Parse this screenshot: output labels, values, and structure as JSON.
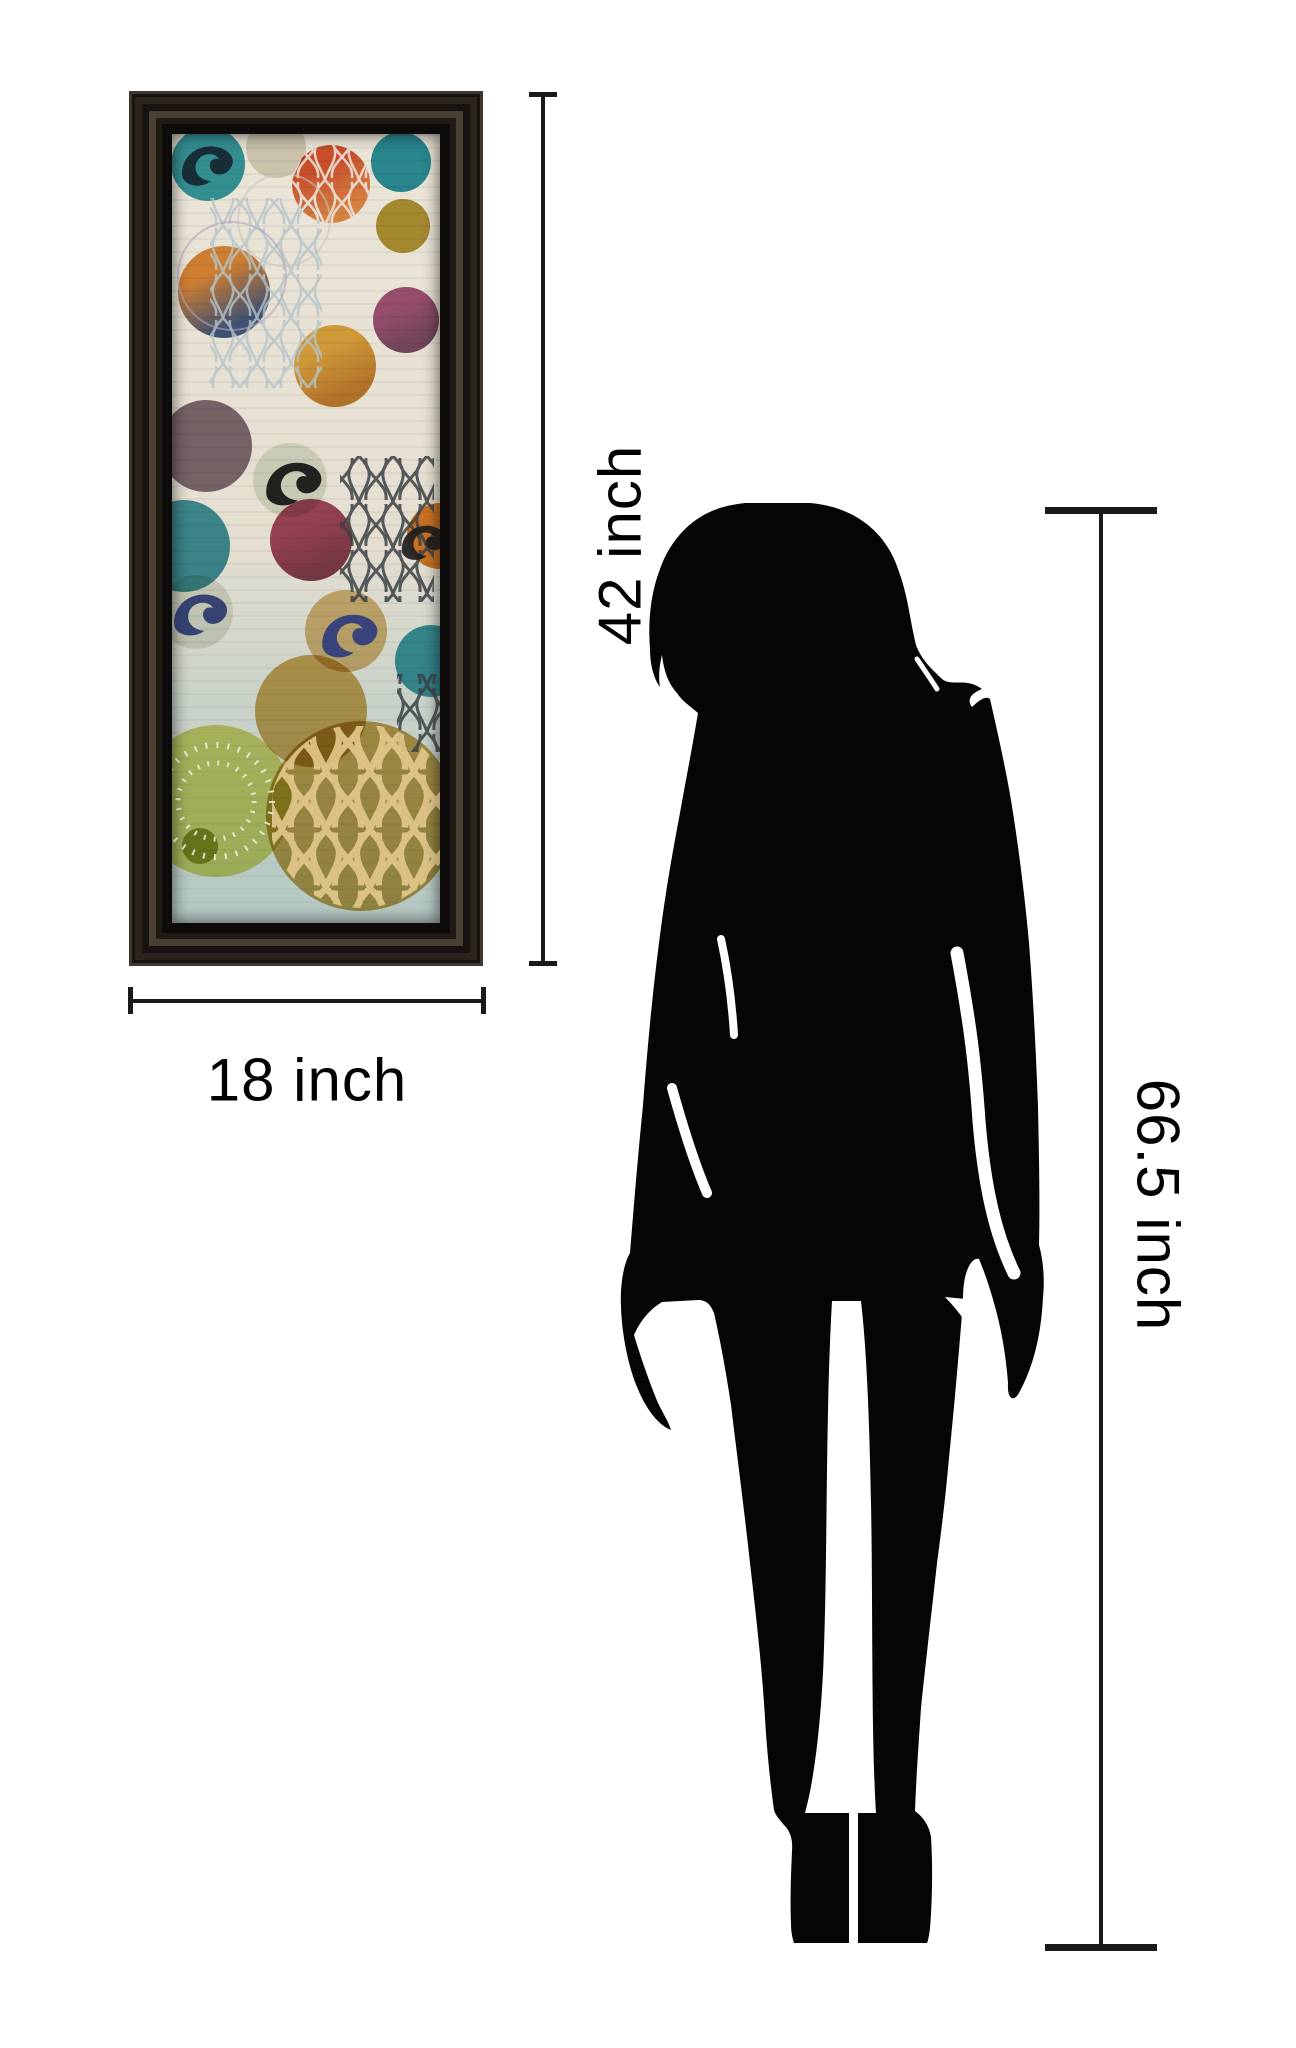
{
  "page": {
    "background": "#ffffff"
  },
  "labels": {
    "artwork_height": "42 inch",
    "artwork_width": "18 inch",
    "person_height": "66.5 inch"
  },
  "annotation_style": {
    "line_color": "#1a1a1a",
    "text_color": "#000000"
  },
  "figure": {
    "type": "standing-woman-silhouette",
    "color": "#000000"
  },
  "artwork": {
    "description": "Abstract print: colorful painted circles with Moroccan trellis and damask motifs on cream ground, dark espresso frame",
    "frame_color": "#1c1712",
    "background": "#e7e2d4",
    "circles": [
      {
        "x": 36,
        "y": 30,
        "r": 37,
        "color": "#2d9aa8",
        "opacity": 0.95
      },
      {
        "x": 104,
        "y": 14,
        "r": 30,
        "color": "#d9d4c6",
        "opacity": 0.9
      },
      {
        "x": 159,
        "y": 50,
        "r": 39,
        "color": "#d84e28",
        "color2": "#e98a45",
        "opacity": 0.95
      },
      {
        "x": 229,
        "y": 28,
        "r": 30,
        "color": "#1f8fa2",
        "opacity": 0.95
      },
      {
        "x": 231,
        "y": 92,
        "r": 27,
        "color": "#ac8d22",
        "opacity": 0.9
      },
      {
        "x": 52,
        "y": 158,
        "r": 46,
        "color": "#e2872f",
        "color2": "#3b5283",
        "opacity": 0.95
      },
      {
        "x": 163,
        "y": 232,
        "r": 41,
        "color": "#e5a93a",
        "color2": "#c27a28",
        "opacity": 0.95
      },
      {
        "x": 234,
        "y": 186,
        "r": 33,
        "color": "#9c4474",
        "color2": "#6d3a59",
        "opacity": 0.9
      },
      {
        "x": 34,
        "y": 312,
        "r": 46,
        "color": "#6b5564",
        "opacity": 0.85
      },
      {
        "x": 118,
        "y": 346,
        "r": 37,
        "color": "#dde6da",
        "opacity": 0.95
      },
      {
        "x": 139,
        "y": 406,
        "r": 41,
        "color": "#a03a55",
        "color2": "#7c2f45",
        "opacity": 0.92
      },
      {
        "x": 12,
        "y": 412,
        "r": 46,
        "color": "#2e8b9b",
        "opacity": 0.9
      },
      {
        "x": 24,
        "y": 478,
        "r": 37,
        "color": "#dfe3da",
        "opacity": 0.9
      },
      {
        "x": 268,
        "y": 402,
        "r": 33,
        "color": "#df7a20",
        "opacity": 0.95
      },
      {
        "x": 174,
        "y": 497,
        "r": 41,
        "color": "#d8b878",
        "opacity": 0.95
      },
      {
        "x": 259,
        "y": 527,
        "r": 36,
        "color": "#2a93a5",
        "opacity": 0.9
      },
      {
        "x": 139,
        "y": 577,
        "r": 56,
        "color": "#c49b3f",
        "opacity": 0.85
      },
      {
        "x": 44,
        "y": 667,
        "r": 76,
        "color": "#ccd04e",
        "opacity": 0.8
      },
      {
        "x": 28,
        "y": 712,
        "r": 18,
        "color": "#99a23a",
        "opacity": 0.9
      },
      {
        "x": 189,
        "y": 682,
        "r": 95,
        "color": "#c5a04a",
        "opacity": 0.95
      }
    ]
  }
}
